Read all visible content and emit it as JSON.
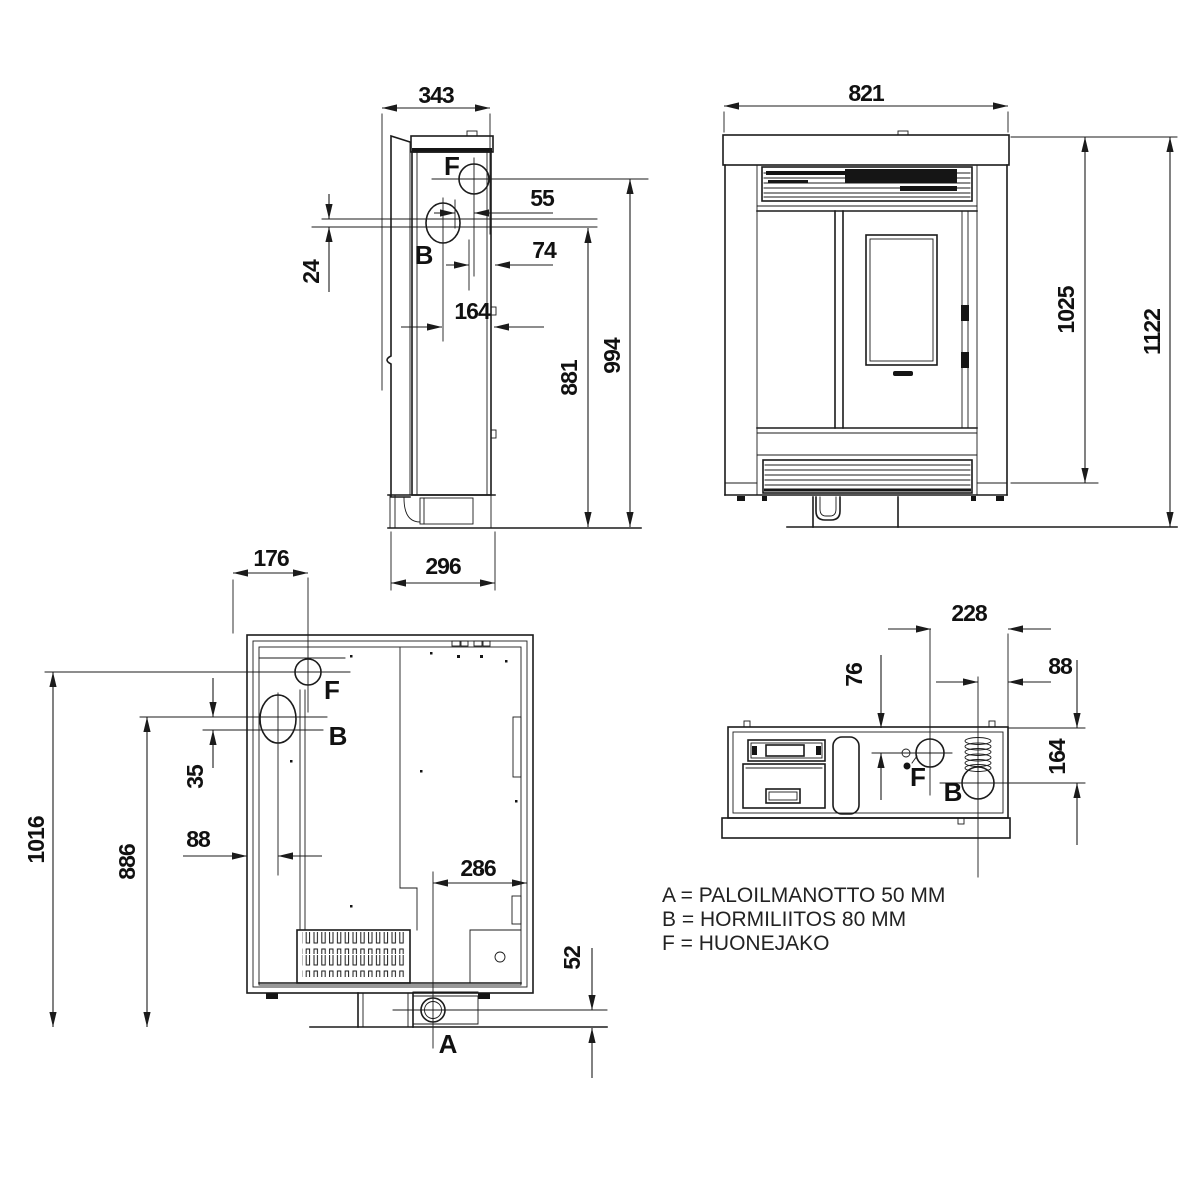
{
  "drawing": {
    "side_view": {
      "dim_343": "343",
      "dim_55": "55",
      "dim_74": "74",
      "dim_24": "24",
      "dim_164": "164",
      "dim_881": "881",
      "dim_994": "994",
      "dim_296": "296",
      "port_f": "F",
      "port_b": "B"
    },
    "front_view": {
      "dim_821": "821",
      "dim_1025": "1025",
      "dim_1122": "1122"
    },
    "section_view": {
      "dim_176": "176",
      "dim_1016": "1016",
      "dim_886": "886",
      "dim_35": "35",
      "dim_88": "88",
      "dim_286": "286",
      "dim_52": "52",
      "port_f": "F",
      "port_b": "B",
      "port_a": "A"
    },
    "top_view": {
      "dim_228": "228",
      "dim_76": "76",
      "dim_88": "88",
      "dim_164": "164",
      "port_f": "F",
      "port_b": "B"
    },
    "legend": {
      "line_a": "A = PALOILMANOTTO 50 MM",
      "line_b": "B = HORMILIITOS 80 MM",
      "line_f": "F = HUONEJAKO"
    }
  }
}
